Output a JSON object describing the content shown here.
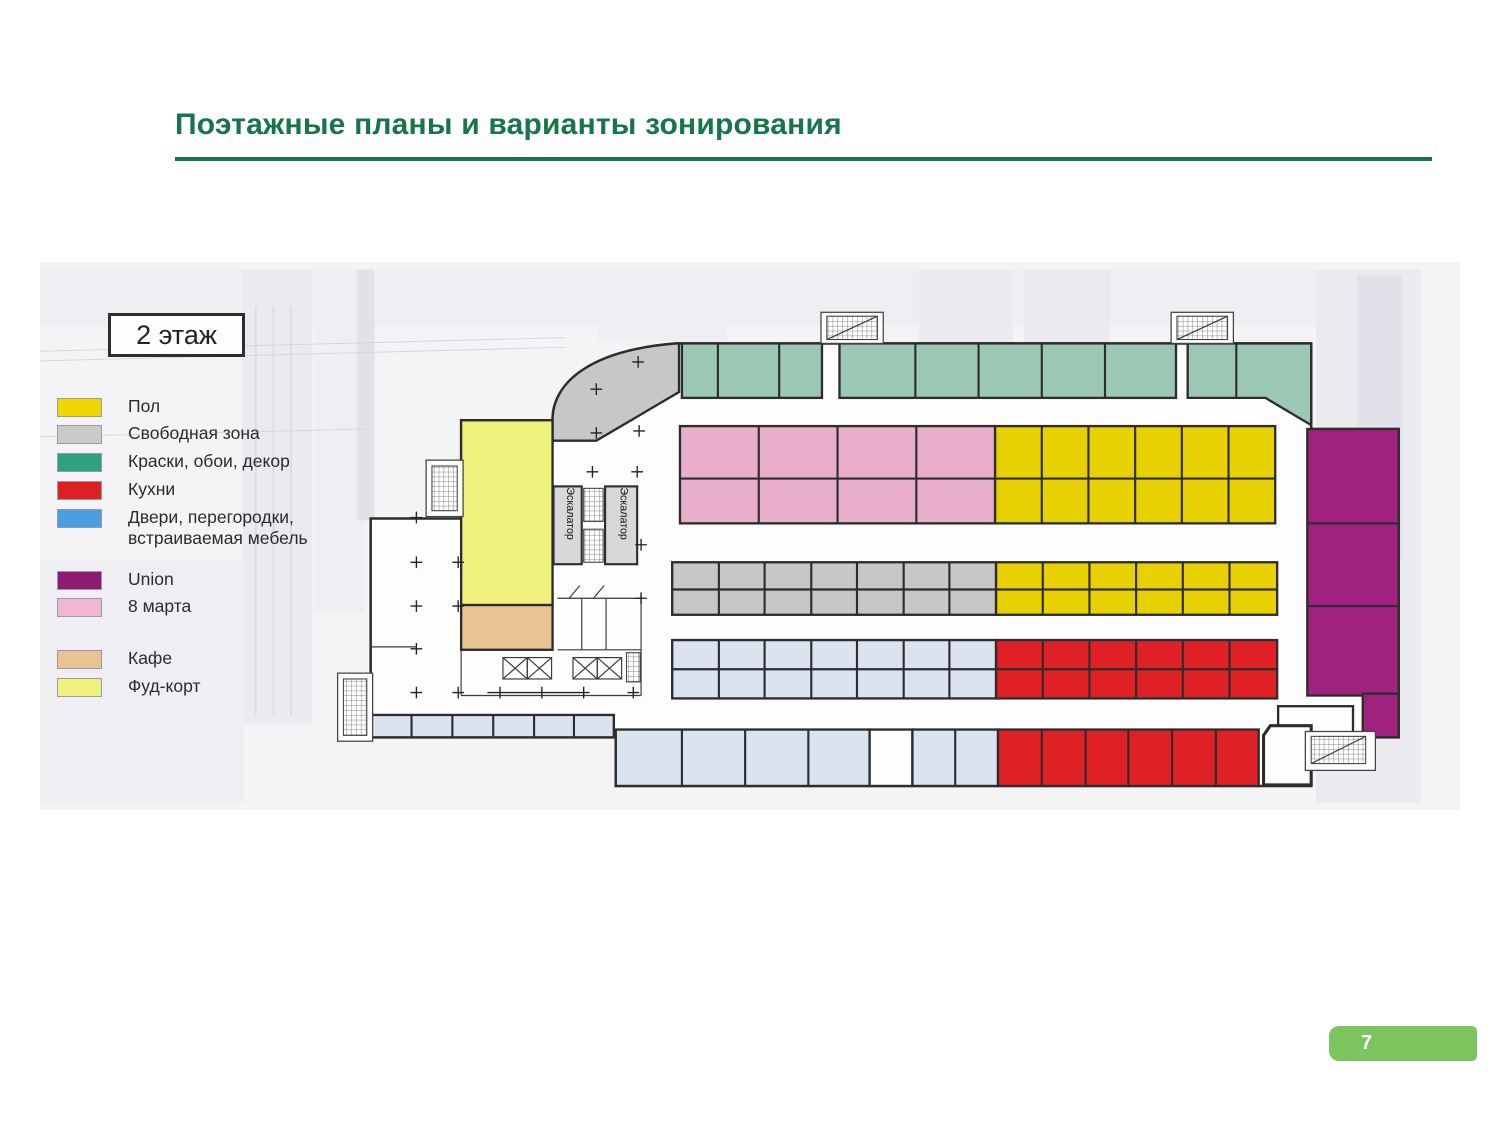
{
  "slide": {
    "title": "Поэтажные планы и варианты зонирования",
    "page_number": "7"
  },
  "plan": {
    "floor_label": "2 этаж",
    "escalator_label": "Эскалатор"
  },
  "legend": {
    "items": [
      {
        "label": "Пол",
        "color": "#f0d600"
      },
      {
        "label": "Свободная зона",
        "color": "#cacaca"
      },
      {
        "label": "Краски, обои, декор",
        "color": "#30a083"
      },
      {
        "label": "Кухни",
        "color": "#dc2026"
      },
      {
        "label": "Двери, перегородки, встраиваемая мебель",
        "color": "#4c9ee3"
      },
      {
        "label": "Union",
        "color": "#8e1b71"
      },
      {
        "label": "8 марта",
        "color": "#f1b7d1"
      },
      {
        "label": "Кафе",
        "color": "#e8c492"
      },
      {
        "label": "Фуд-корт",
        "color": "#eef17d"
      }
    ]
  },
  "colors": {
    "title-green": "#177549",
    "page-green": "#7cc45d",
    "wall": "#2d2d2d",
    "zone-yellow": "#e8d103",
    "zone-gray": "#c7c7c7",
    "zone-teal": "#9cc7b4",
    "zone-red": "#df2126",
    "zone-blue": "#dbe2f0",
    "zone-purple": "#a02180",
    "zone-pink": "#e9aeca",
    "zone-tan": "#e8c492",
    "zone-foodcourt": "#eef17c"
  }
}
